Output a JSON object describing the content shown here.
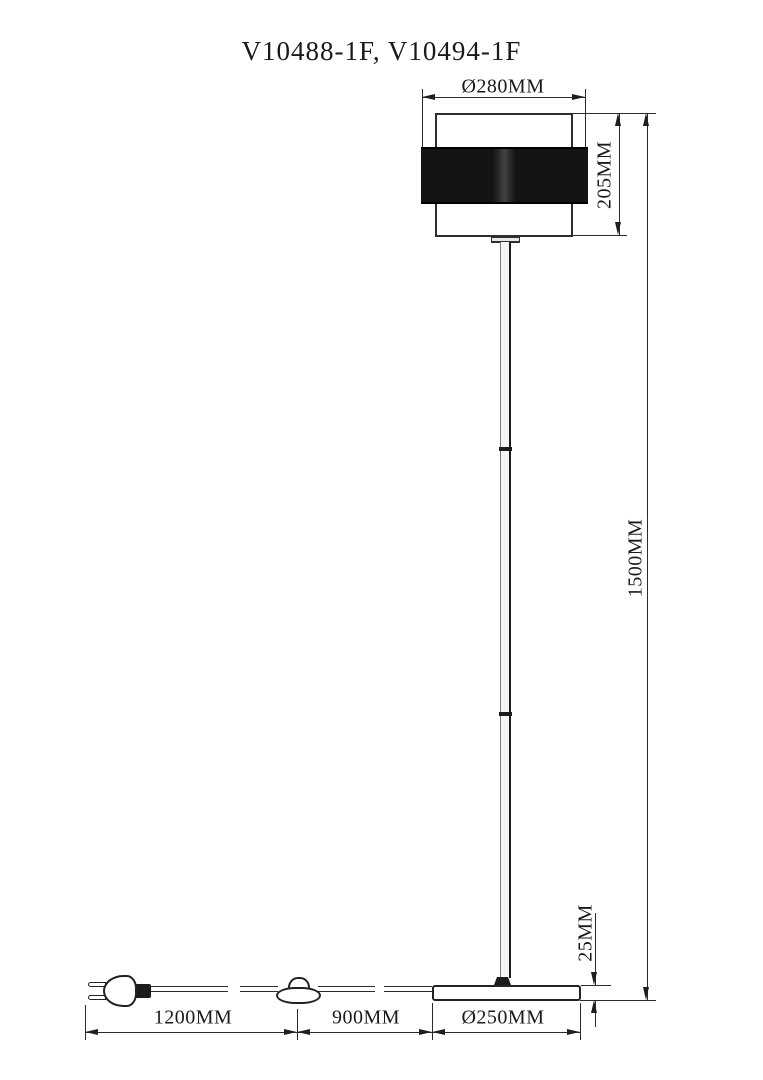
{
  "title": "V10488-1F, V10494-1F",
  "dimensions": {
    "shade_diameter": "Ø280MM",
    "shade_height": "205MM",
    "total_height": "1500MM",
    "base_thickness": "25MM",
    "plug_to_switch": "1200MM",
    "switch_to_base": "900MM",
    "base_diameter": "Ø250MM"
  },
  "colors": {
    "line": "#2b2b2b",
    "object_outline": "#242424",
    "shade_band_fill": "#0c0c0c",
    "background": "#ffffff"
  }
}
